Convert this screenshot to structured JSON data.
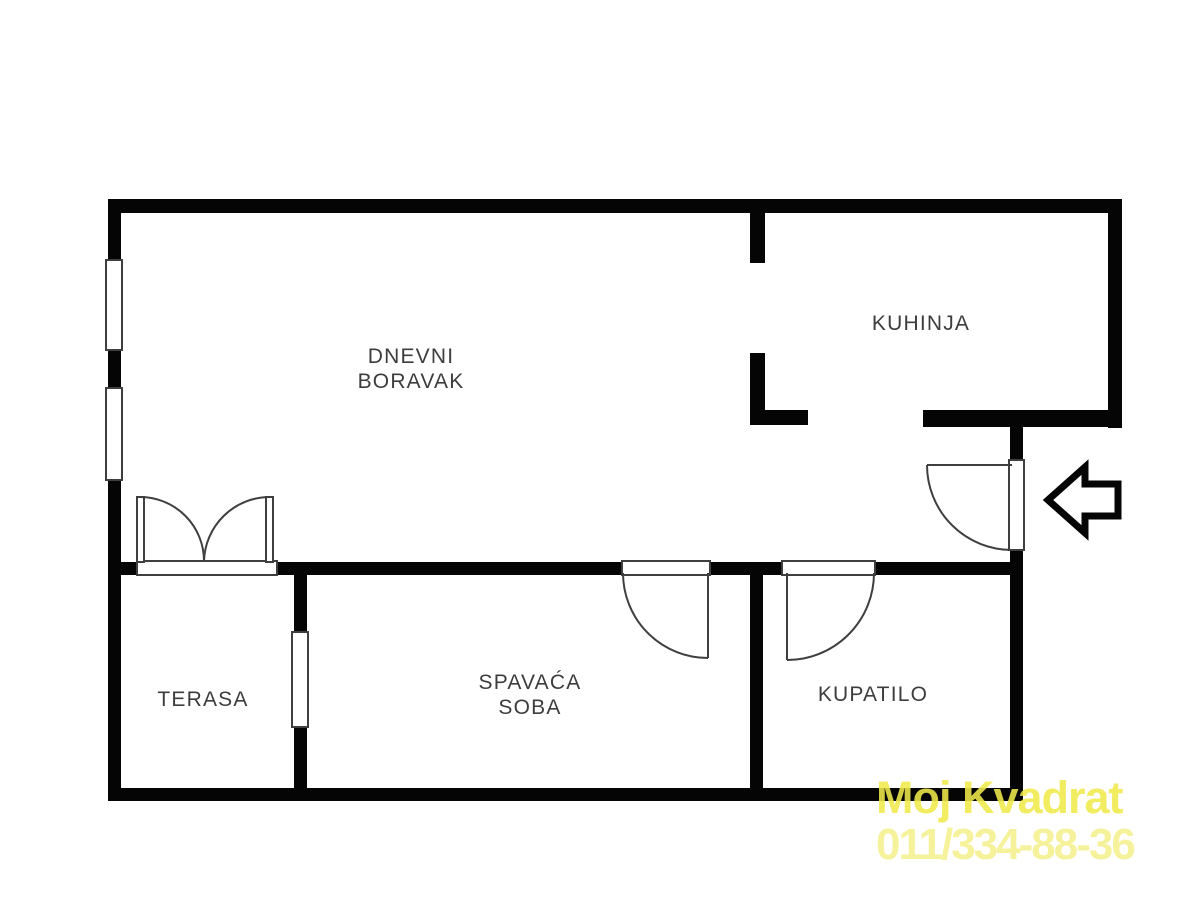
{
  "title": "Apartment floor plan",
  "rooms": {
    "living": {
      "line1": "DNEVNI",
      "line2": "BORAVAK"
    },
    "kitchen": {
      "label": "KUHINJA"
    },
    "terrace": {
      "label": "TERASA"
    },
    "bedroom": {
      "line1": "SPAVAĆA",
      "line2": "SOBA"
    },
    "bathroom": {
      "label": "KUPATILO"
    }
  },
  "watermark": {
    "line1": "Moj Kvadrat",
    "line2": "011/334-88-36",
    "color_line1": "#F0E94B",
    "color_line2": "#F6F196"
  },
  "colors": {
    "wall": "#050505",
    "background": "#FFFFFF",
    "label_text": "#3D3D3D",
    "door_line": "#3F3F3F"
  },
  "icons": {
    "entrance_arrow": "left-arrow-icon"
  },
  "features": {
    "windows": 3,
    "door_swings": 4,
    "balcony_double_door": true
  }
}
